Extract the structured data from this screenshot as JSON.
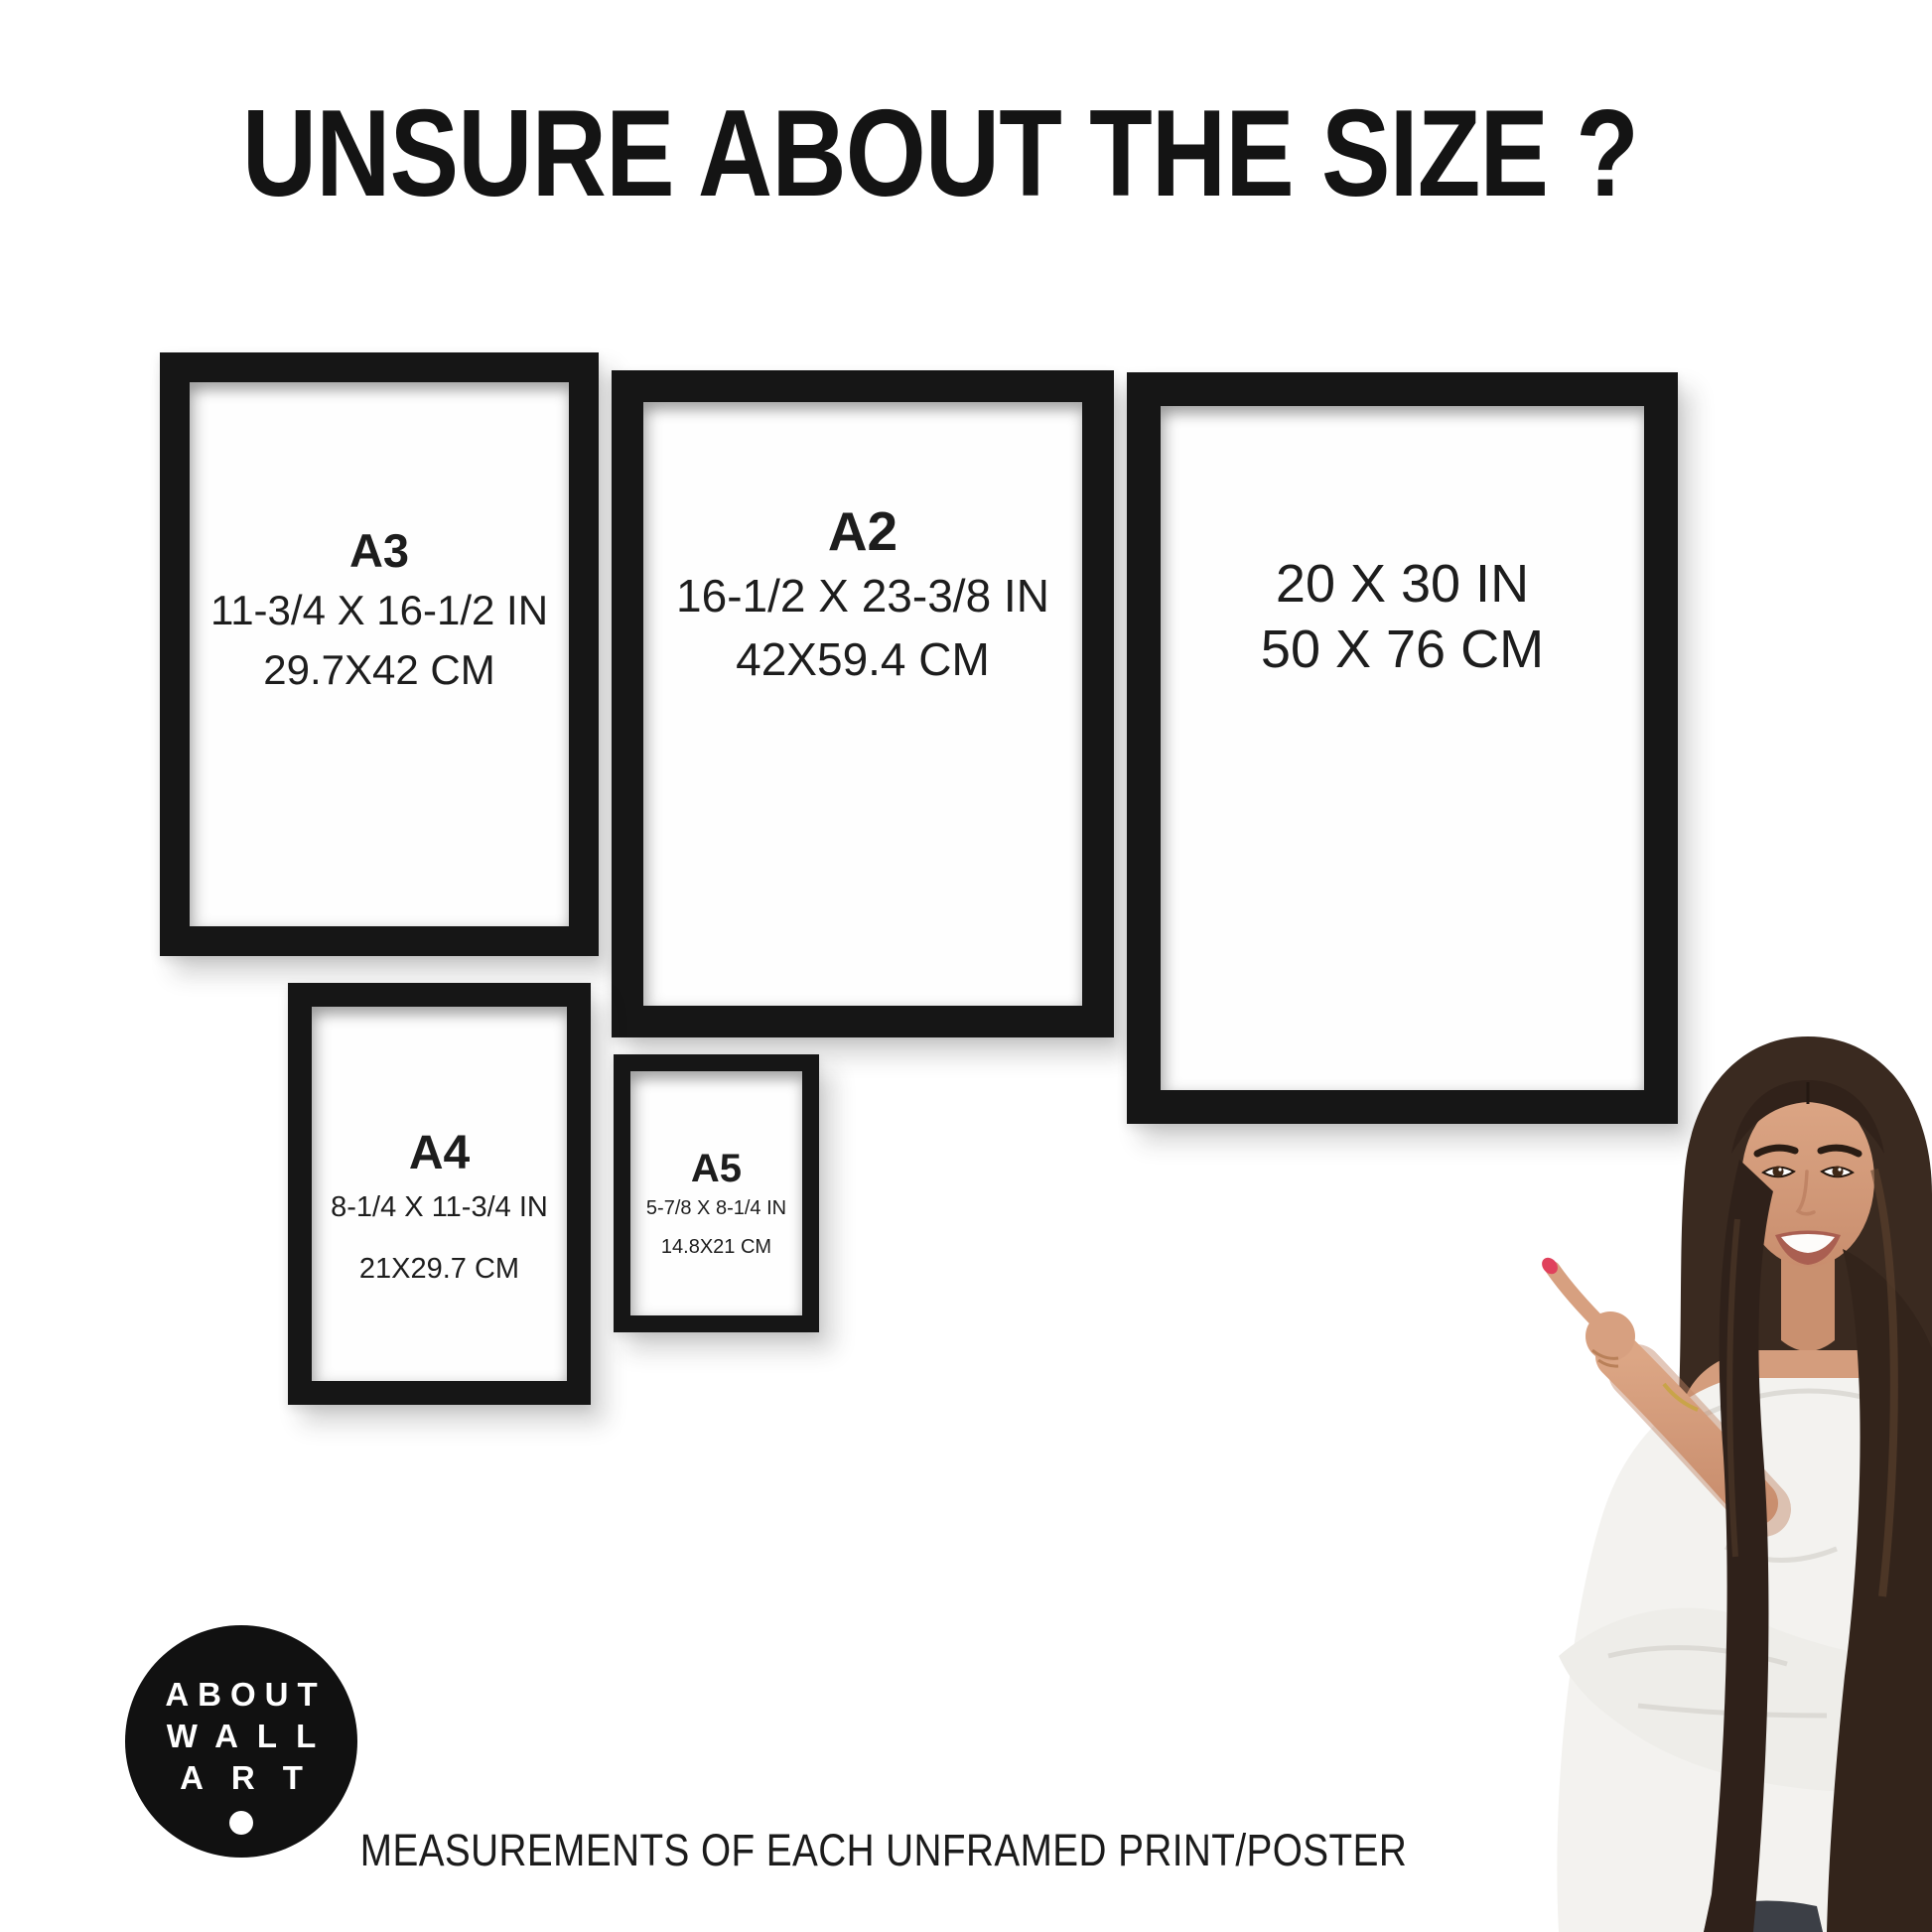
{
  "page": {
    "title": "UNSURE ABOUT THE SIZE ?",
    "caption": "MEASUREMENTS OF EACH UNFRAMED PRINT/POSTER"
  },
  "frames": {
    "a3": {
      "label": "A3",
      "inches": "11-3/4 X 16-1/2 IN",
      "cm": "29.7X42 CM"
    },
    "a2": {
      "label": "A2",
      "inches": "16-1/2 X 23-3/8 IN",
      "cm": "42X59.4 CM"
    },
    "size20x30": {
      "inches": "20 X 30 IN",
      "cm": "50 X 76 CM"
    },
    "a4": {
      "label": "A4",
      "inches": "8-1/4 X 11-3/4 IN",
      "cm": "21X29.7 CM"
    },
    "a5": {
      "label": "A5",
      "inches": "5-7/8 X 8-1/4 IN",
      "cm": "14.8X21 CM"
    }
  },
  "logo": {
    "line1": "ABOUT",
    "line2": "WALL",
    "line3": "ART"
  },
  "illustration": {
    "name": "woman-pointing"
  },
  "colors": {
    "background": "#ffffff",
    "frame": "#161616",
    "text": "#1c1c1c",
    "logo_bg": "#111111",
    "hair": "#3a2a20",
    "skin": "#d29a7c",
    "blouse": "#f3f2ef",
    "nail": "#e0415c"
  }
}
